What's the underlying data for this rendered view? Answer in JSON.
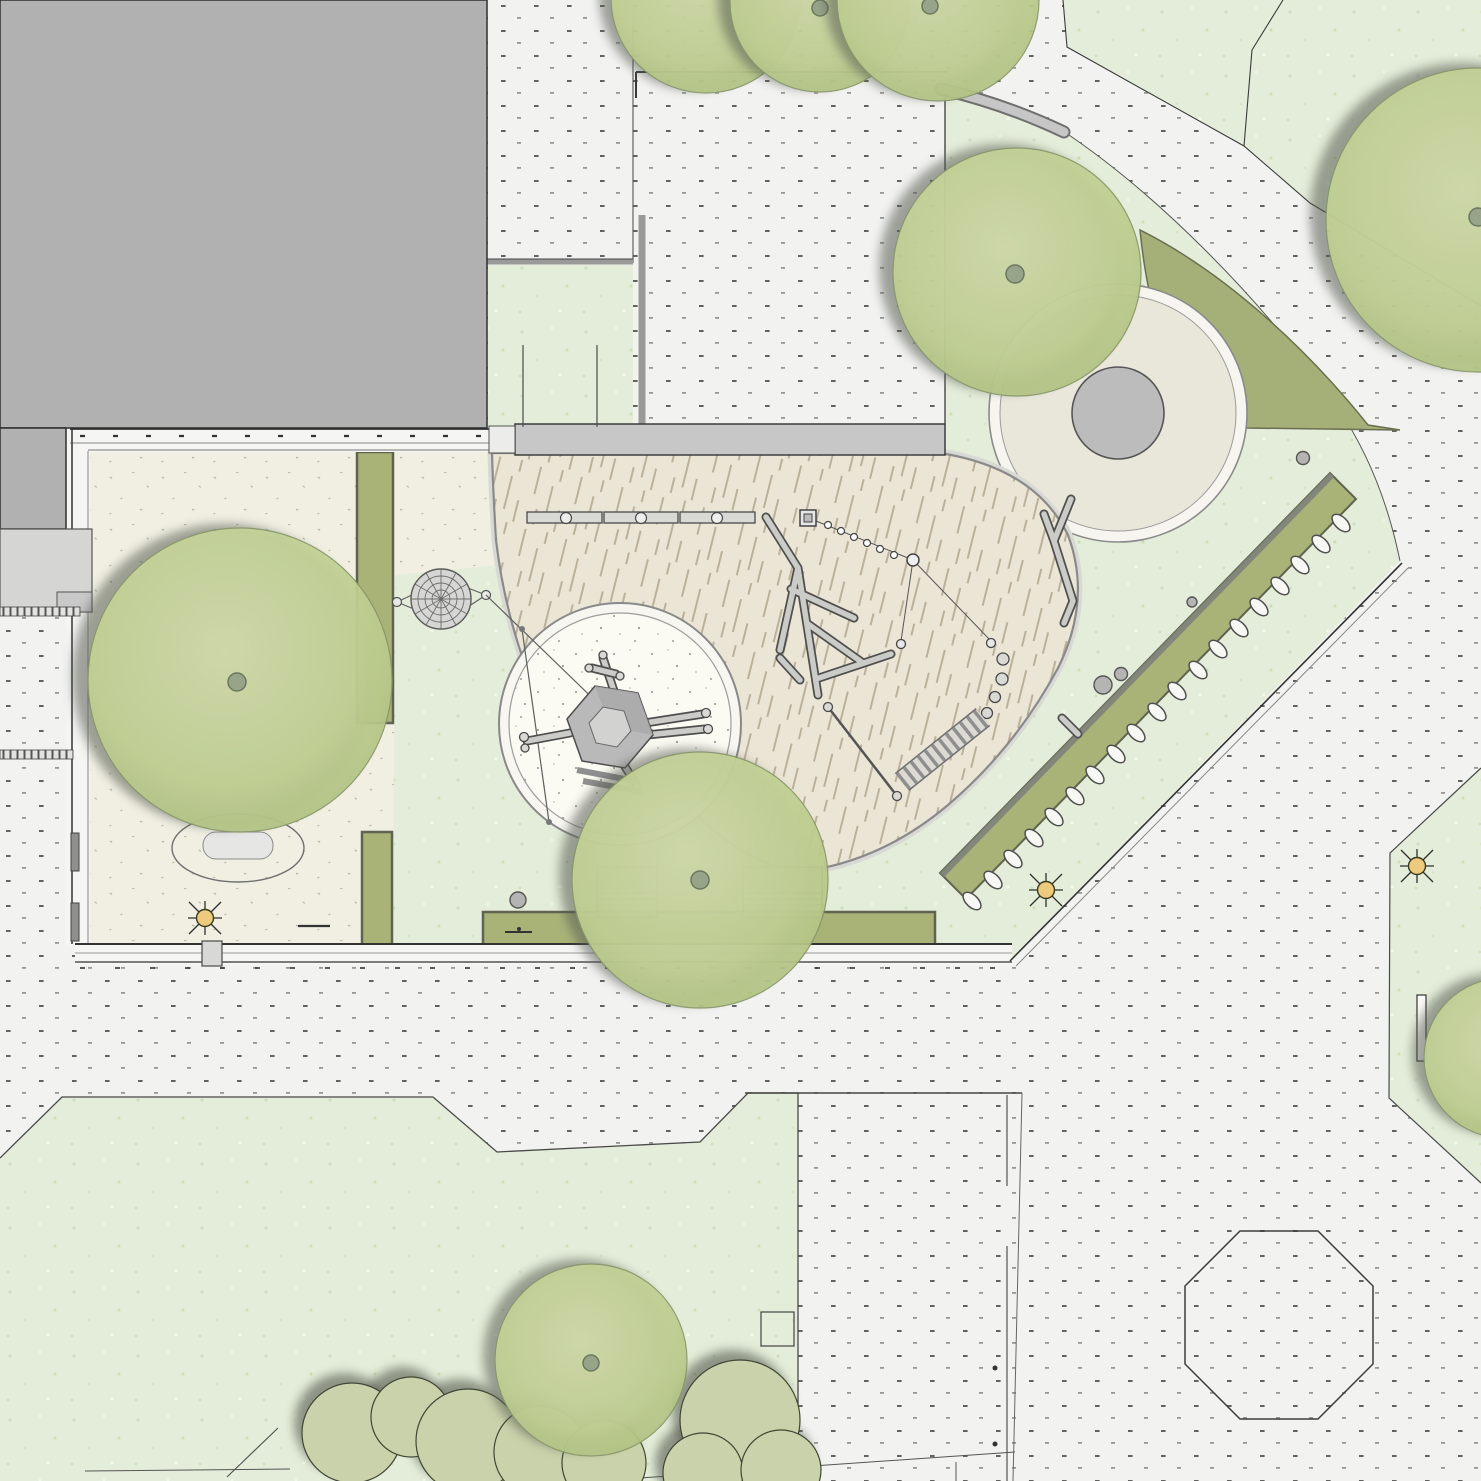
{
  "plan": {
    "kind": "landscape-architecture-site-plan",
    "view": "top-down",
    "visible_text": "none"
  },
  "palette": {
    "building": "#b1b1b1",
    "pavement": "#f2f2f0",
    "pavement-dot": "#3f3f3f",
    "lawn": "#e4edd9",
    "yard": "#f0efe2",
    "bark": "#ebe5d5",
    "sand": "#fbfaf3",
    "tree-light": "#d2dcab",
    "tree-mid": "#c2d194",
    "tree-dark": "#aebf7f",
    "hedge": "#a9b378",
    "wedge": "#a5b078",
    "shrub": "#cad2ab",
    "wall": "#c7c7c7",
    "plaza-fill": "#e9e6da",
    "plaza-center": "#bcbcbc",
    "sun": "#eecb7c",
    "line": "#3a3a3a"
  },
  "features": {
    "building": {
      "shape": "L-shaped block, top-left",
      "count": 1
    },
    "trees": {
      "count": 9
    },
    "shrub_clusters": {
      "count": 3
    },
    "hedges": {
      "count": 4
    },
    "willow_tunnel_arches": {
      "count": 19
    },
    "play_equipment": [
      "balance-beam-row-3",
      "spider-web-climber",
      "sand-circle-with-hex-tower",
      "log-jumble",
      "stepping-disc-course",
      "stepping-pods-4",
      "wooden-ramp",
      "slack-rope",
      "picnic-tables-2"
    ],
    "site_furniture": [
      "sun-lamps-3",
      "bollards-5",
      "gates-2",
      "bench-wall",
      "oval-bench"
    ],
    "surfaces": [
      "dotted-paving",
      "lawn",
      "sand-yard",
      "bark-mulch-area",
      "sand-circle",
      "circular-plaza"
    ],
    "other": [
      "octagon-pad",
      "property-lines",
      "fences"
    ]
  }
}
